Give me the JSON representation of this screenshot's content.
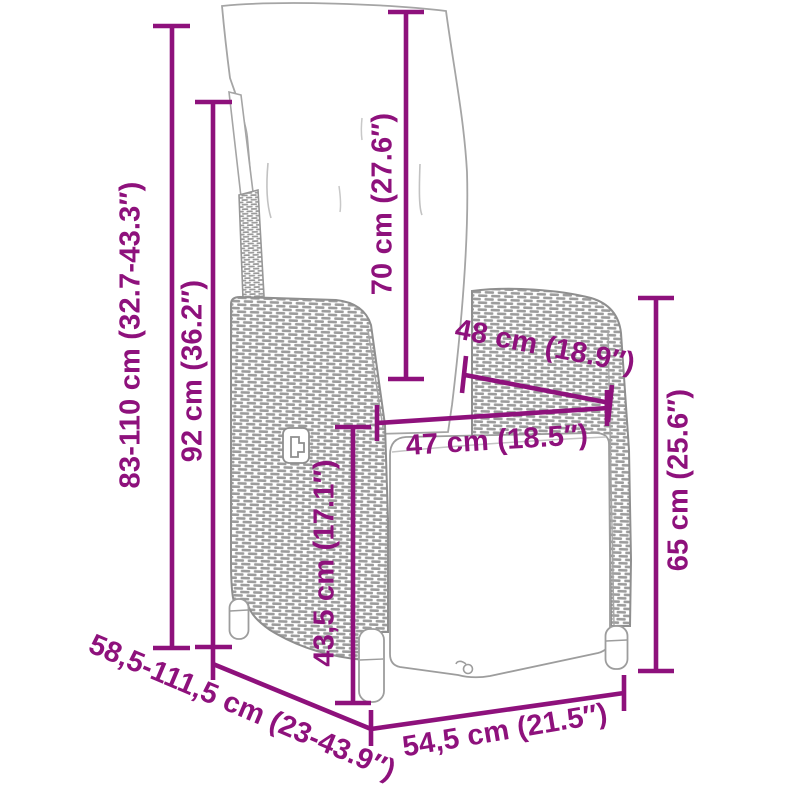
{
  "diagram": {
    "accent_color": "#8e117c",
    "artwork_color": "#9f9f9f",
    "labels": {
      "back_height": "83-110 cm (32.7-43.3″)",
      "total_height": "92 cm (36.2″)",
      "backrest_length": "70 cm (27.6″)",
      "armrest_depth": "48 cm (18.9″)",
      "seat_width": "47 cm (18.5″)",
      "seat_height": "43,5 cm (17.1″)",
      "armrest_height": "65 cm (25.6″)",
      "depth_range": "58,5-111,5 cm (23-43.9″)",
      "total_width": "54,5 cm (21.5″)"
    }
  }
}
